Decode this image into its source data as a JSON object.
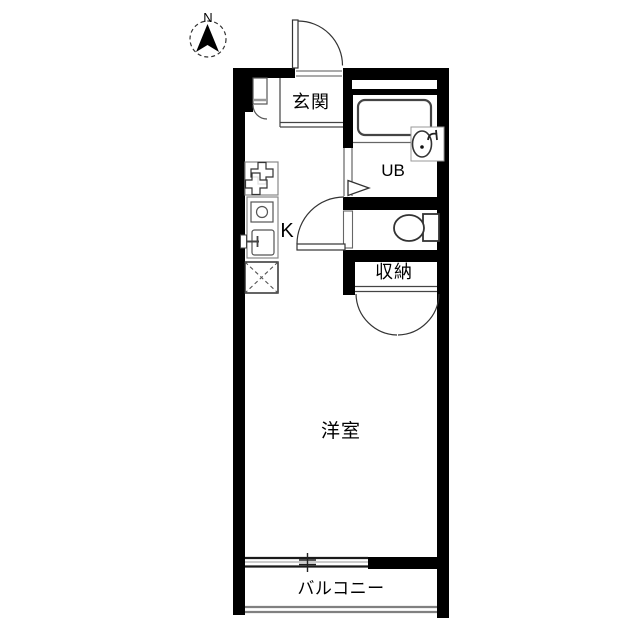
{
  "compass": {
    "label": "N"
  },
  "rooms": {
    "genkan": {
      "label": "玄関"
    },
    "unit_bath": {
      "label": "UB"
    },
    "kitchen": {
      "label": "K"
    },
    "storage": {
      "label": "収納"
    },
    "western_room": {
      "label": "洋室"
    },
    "balcony": {
      "label": "バルコニー"
    }
  },
  "icons": {
    "compass_needle": "north-arrow-icon",
    "entrance_door": "door-swing-icon",
    "hall_door": "door-swing-icon",
    "small_closet_door": "door-swing-icon",
    "ub_door": "door-triangle-icon",
    "toilet_door": "door-leaf-icon",
    "closet_doors": "double-door-swing-icon",
    "bathtub": "bathtub-icon",
    "washbasin": "washbasin-icon",
    "toilet": "toilet-icon",
    "stove": "stove-burners-icon",
    "kitchen_sink": "kitchen-sink-icon",
    "refrigerator_space": "refrigerator-space-icon",
    "window": "sliding-window-icon",
    "railing": "balcony-railing-icon"
  },
  "colors": {
    "wall": "#000000",
    "fixture": "#444444",
    "thin_line": "#888888",
    "background": "#ffffff",
    "text": "#000000"
  }
}
